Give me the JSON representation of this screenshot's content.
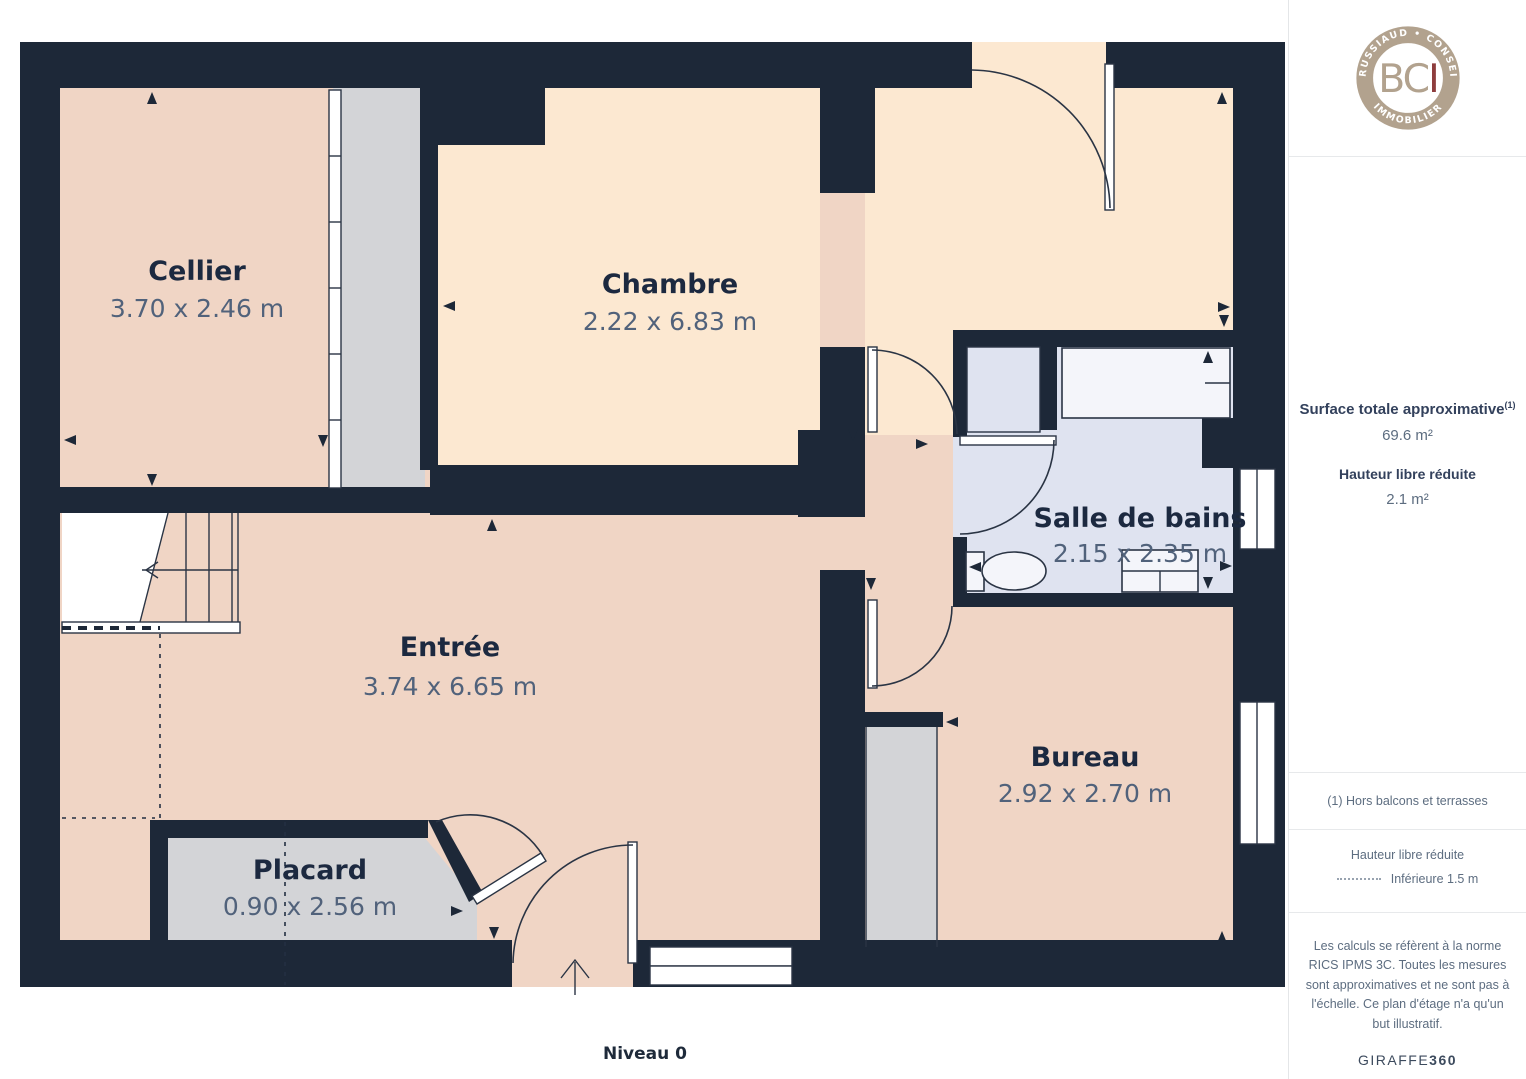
{
  "plan": {
    "level_label": "Niveau 0",
    "rooms": [
      {
        "id": "cellier",
        "name": "Cellier",
        "dimensions": "3.70 x 2.46 m"
      },
      {
        "id": "chambre",
        "name": "Chambre",
        "dimensions": "2.22 x 6.83 m"
      },
      {
        "id": "salle-de-bains",
        "name": "Salle de bains",
        "dimensions": "2.15 x 2.35 m"
      },
      {
        "id": "entree",
        "name": "Entrée",
        "dimensions": "3.74 x 6.65 m"
      },
      {
        "id": "bureau",
        "name": "Bureau",
        "dimensions": "2.92 x 2.70 m"
      },
      {
        "id": "placard",
        "name": "Placard",
        "dimensions": "0.90 x 2.56 m"
      }
    ],
    "colors": {
      "wall": "#1d2838",
      "floor_pink": "#f0d5c5",
      "floor_cream": "#fce8d1",
      "floor_blue": "#dfe3f0",
      "closet_gray": "#d3d4d7"
    }
  },
  "sidebar": {
    "logo": {
      "arc_top": "BRUSSIAUD • CONSEIL",
      "arc_bottom": "IMMOBILIER",
      "initials_primary": "BC",
      "initials_accent": "I",
      "ring_color": "#b2a28e",
      "accent_color": "#8e3d3d"
    },
    "surface_label": "Surface totale approximative",
    "surface_footnote_marker": "(1)",
    "surface_value": "69.6 m²",
    "height_label": "Hauteur libre réduite",
    "height_value": "2.1 m²",
    "footnote": "(1) Hors balcons et terrasses",
    "legend_title": "Hauteur libre réduite",
    "legend_value": "Inférieure 1.5 m",
    "disclaimer": "Les calculs se réfèrent à la norme RICS IPMS 3C. Toutes les mesures sont approximatives et ne sont pas à l'échelle. Ce plan d'étage n'a qu'un but illustratif.",
    "brand": "GIRAFFE",
    "brand_suffix": "360"
  }
}
